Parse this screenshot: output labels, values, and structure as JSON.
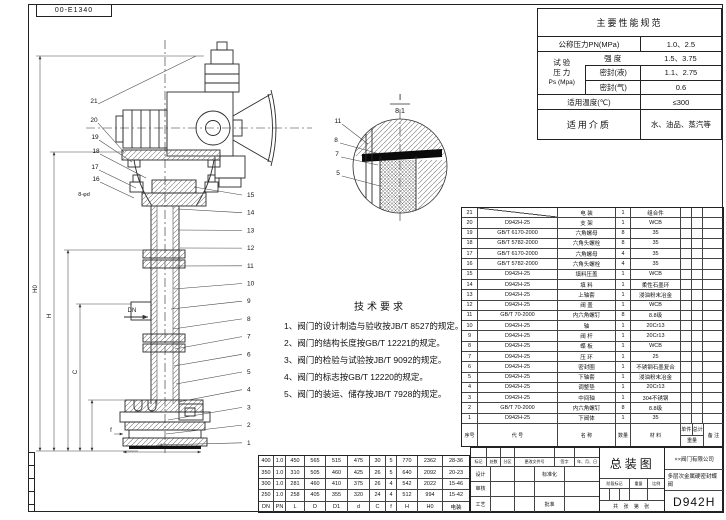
{
  "sheet": {
    "corner_code": "00-E1340"
  },
  "spec_table": {
    "title": "主要性能规范",
    "pn_label": "公称压力PN(MPa)",
    "pn_value": "1.0、2.5",
    "test_label_1": "试 验",
    "test_label_2": "压 力",
    "test_label_3": "Ps (Mpa)",
    "strength_label": "强  度",
    "strength_value": "1.5、3.75",
    "seal_liquid_label": "密封(液)",
    "seal_liquid_value": "1.1、2.75",
    "seal_gas_label": "密封(气)",
    "seal_gas_value": "0.6",
    "temp_label": "适用温度(℃)",
    "temp_value": "≤300",
    "medium_label": "适用介质",
    "medium_value": "水、油品、蒸汽等"
  },
  "tech_req": {
    "title": "技术要求",
    "items": [
      "1、阀门的设计制造与验收按JB/T 8527的规定。",
      "2、阀门的结构长度按GB/T 12221的规定。",
      "3、阀门的检验与试验按JB/T 9092的规定。",
      "4、阀门的标志按GB/T 12220的规定。",
      "5、阀门的装运、储存按JB/T 7928的规定。"
    ]
  },
  "parts_table": {
    "headers": {
      "no": "序号",
      "code": "代  号",
      "name": "名  称",
      "qty": "数量",
      "material": "材  料",
      "weight": "重量",
      "unit": "单件",
      "total": "总计",
      "remark": "备 注"
    },
    "rows": [
      {
        "no": "21",
        "code": "",
        "name": "电 装",
        "qty": "1",
        "material": "组合件",
        "remark": ""
      },
      {
        "no": "20",
        "code": "D942H-25",
        "name": "支 架",
        "qty": "1",
        "material": "WCB",
        "remark": ""
      },
      {
        "no": "19",
        "code": "GB/T 6170-2000",
        "name": "六角螺母",
        "qty": "8",
        "material": "35",
        "remark": ""
      },
      {
        "no": "18",
        "code": "GB/T 5782-2000",
        "name": "六角头螺栓",
        "qty": "8",
        "material": "35",
        "remark": ""
      },
      {
        "no": "17",
        "code": "GB/T 6170-2000",
        "name": "六角螺母",
        "qty": "4",
        "material": "35",
        "remark": ""
      },
      {
        "no": "16",
        "code": "GB/T 5782-2000",
        "name": "六角头螺栓",
        "qty": "4",
        "material": "35",
        "remark": ""
      },
      {
        "no": "15",
        "code": "D942H-25",
        "name": "填料压盖",
        "qty": "1",
        "material": "WCB",
        "remark": ""
      },
      {
        "no": "14",
        "code": "D942H-25",
        "name": "填 料",
        "qty": "1",
        "material": "柔性石墨环",
        "remark": ""
      },
      {
        "no": "13",
        "code": "D942H-25",
        "name": "上轴套",
        "qty": "1",
        "material": "浸油粉末冶金",
        "remark": ""
      },
      {
        "no": "12",
        "code": "D942H-25",
        "name": "阀 盖",
        "qty": "1",
        "material": "WCB",
        "remark": ""
      },
      {
        "no": "11",
        "code": "GB/T 70-2000",
        "name": "内六角螺钉",
        "qty": "8",
        "material": "8.8级",
        "remark": ""
      },
      {
        "no": "10",
        "code": "D942H-25",
        "name": "轴",
        "qty": "1",
        "material": "20Cr13",
        "remark": ""
      },
      {
        "no": "9",
        "code": "D942H-25",
        "name": "阀 杆",
        "qty": "1",
        "material": "20Cr13",
        "remark": ""
      },
      {
        "no": "8",
        "code": "D942H-25",
        "name": "蝶 板",
        "qty": "1",
        "material": "WCB",
        "remark": ""
      },
      {
        "no": "7",
        "code": "D942H-25",
        "name": "压 环",
        "qty": "1",
        "material": "25",
        "remark": ""
      },
      {
        "no": "6",
        "code": "D942H-25",
        "name": "密封圈",
        "qty": "1",
        "material": "不锈钢石墨复合",
        "remark": ""
      },
      {
        "no": "5",
        "code": "D942H-25",
        "name": "下轴套",
        "qty": "1",
        "material": "浸油粉末冶金",
        "remark": ""
      },
      {
        "no": "4",
        "code": "D942H-25",
        "name": "调整垫",
        "qty": "1",
        "material": "20Cr13",
        "remark": ""
      },
      {
        "no": "3",
        "code": "D942H-25",
        "name": "中间轴",
        "qty": "1",
        "material": "304不锈钢",
        "remark": ""
      },
      {
        "no": "2",
        "code": "GB/T 70-2000",
        "name": "内六角螺钉",
        "qty": "8",
        "material": "8.8级",
        "remark": ""
      },
      {
        "no": "1",
        "code": "D942H-25",
        "name": "下阀体",
        "qty": "1",
        "material": "35",
        "remark": ""
      }
    ]
  },
  "dim_table": {
    "columns": [
      "DN",
      "PN",
      "L",
      "D",
      "D1",
      "d",
      "C",
      "f",
      "H",
      "H0",
      "电装"
    ],
    "rows": [
      [
        "400",
        "1.0",
        "450",
        "565",
        "515",
        "475",
        "30",
        "5",
        "770",
        "2362",
        "28-36"
      ],
      [
        "350",
        "1.0",
        "310",
        "505",
        "460",
        "425",
        "26",
        "5",
        "640",
        "2092",
        "20-23"
      ],
      [
        "300",
        "1.0",
        "281",
        "460",
        "410",
        "375",
        "26",
        "4",
        "542",
        "2022",
        "15-46"
      ],
      [
        "250",
        "1.0",
        "258",
        "405",
        "355",
        "320",
        "24",
        "4",
        "512",
        "994",
        "15-42"
      ]
    ]
  },
  "title_block": {
    "drawing_title": "总装图",
    "company": "××阀门有限公司",
    "product_name": "多层次金属硬密封蝶阀",
    "model": "D942H",
    "rev_headers": [
      "标记",
      "处数",
      "分区",
      "更改文件号",
      "签字",
      "年、月、日"
    ],
    "role_design": "设计",
    "role_check": "审核",
    "role_process": "工艺",
    "role_standard": "标准化",
    "role_approve": "批准",
    "stage_label": "阶段标记",
    "weight_label": "重量",
    "scale_label": "比例",
    "sheets_label": "共 张 第 张"
  },
  "drawing": {
    "detail_label": "I",
    "detail_scale": "8:1",
    "hole_callout": "8-φd",
    "balloons_left": [
      "21",
      "20",
      "19",
      "18",
      "17",
      "16"
    ],
    "balloons_right": [
      "15",
      "14",
      "13",
      "12",
      "11",
      "10",
      "9",
      "8",
      "7",
      "6",
      "5",
      "4",
      "3",
      "2",
      "1"
    ],
    "balloons_detail": [
      "11",
      "8",
      "7",
      "5"
    ],
    "dims": [
      "H0",
      "H",
      "C",
      "DN",
      "L",
      "f"
    ]
  }
}
